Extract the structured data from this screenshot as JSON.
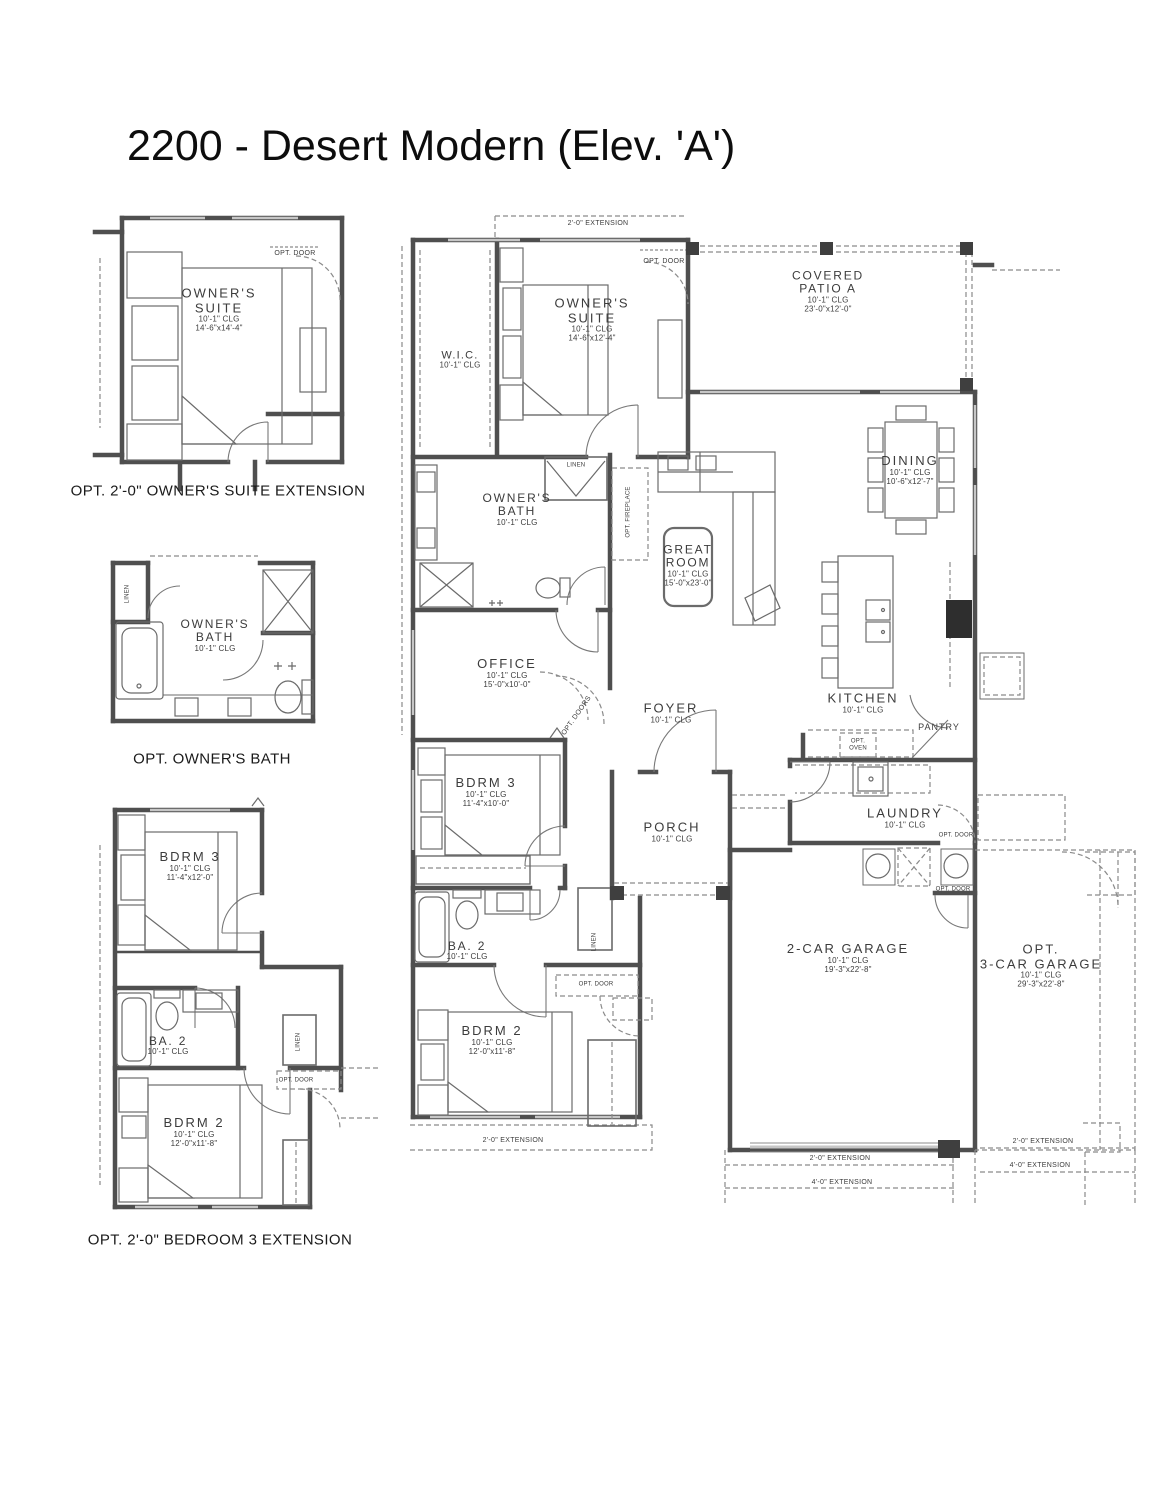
{
  "title": "2200 - Desert Modern (Elev. 'A')",
  "captions": {
    "owners_suite_extension": "OPT. 2'-0\" OWNER'S SUITE EXTENSION",
    "owners_bath": "OPT. OWNER'S BATH",
    "bedroom3_extension": "OPT. 2'-0\" BEDROOM 3 EXTENSION"
  },
  "rooms": {
    "ext_owners_suite": {
      "name1": "OWNER'S",
      "name2": "SUITE",
      "clg": "10'-1\" CLG",
      "dims": "14'-6\"x14'-4\""
    },
    "opt_owners_bath": {
      "name1": "OWNER'S",
      "name2": "BATH",
      "clg": "10'-1\" CLG"
    },
    "ext_bdrm3": {
      "name": "BDRM 3",
      "clg": "10'-1\" CLG",
      "dims": "11'-4\"x12'-0\""
    },
    "ext_ba2": {
      "name": "BA. 2",
      "clg": "10'-1\" CLG"
    },
    "ext_bdrm2": {
      "name": "BDRM 2",
      "clg": "10'-1\" CLG",
      "dims": "12'-0\"x11'-8\""
    },
    "wic": {
      "name": "W.I.C.",
      "clg": "10'-1\" CLG"
    },
    "owners_suite": {
      "name1": "OWNER'S",
      "name2": "SUITE",
      "clg": "10'-1\" CLG",
      "dims": "14'-6\"x12'-4\""
    },
    "covered_patio": {
      "name1": "COVERED",
      "name2": "PATIO A",
      "clg": "10'-1\" CLG",
      "dims": "23'-0\"x12'-0\""
    },
    "dining": {
      "name": "DINING",
      "clg": "10'-1\" CLG",
      "dims": "10'-6\"x12'-7\""
    },
    "owners_bath": {
      "name1": "OWNER'S",
      "name2": "BATH",
      "clg": "10'-1\" CLG"
    },
    "great_room": {
      "name1": "GREAT",
      "name2": "ROOM",
      "clg": "10'-1\" CLG",
      "dims": "15'-0\"x23'-0\""
    },
    "office": {
      "name": "OFFICE",
      "clg": "10'-1\" CLG",
      "dims": "15'-0\"x10'-0\""
    },
    "kitchen": {
      "name": "KITCHEN",
      "clg": "10'-1\" CLG"
    },
    "foyer": {
      "name": "FOYER",
      "clg": "10'-1\" CLG"
    },
    "pantry": {
      "name": "PANTRY"
    },
    "laundry": {
      "name": "LAUNDRY",
      "clg": "10'-1\" CLG"
    },
    "bdrm3": {
      "name": "BDRM 3",
      "clg": "10'-1\" CLG",
      "dims": "11'-4\"x10'-0\""
    },
    "ba2": {
      "name": "BA. 2",
      "clg": "10'-1\" CLG"
    },
    "bdrm2": {
      "name": "BDRM 2",
      "clg": "10'-1\" CLG",
      "dims": "12'-0\"x11'-8\""
    },
    "porch": {
      "name": "PORCH",
      "clg": "10'-1\" CLG"
    },
    "garage_2car": {
      "name": "2-CAR GARAGE",
      "clg": "10'-1\" CLG",
      "dims": "19'-3\"x22'-8\""
    },
    "garage_3car": {
      "name1": "OPT.",
      "name2": "3-CAR GARAGE",
      "clg": "10'-1\" CLG",
      "dims": "29'-3\"x22'-8\""
    }
  },
  "annotations": {
    "opt_door": "OPT. DOOR",
    "opt_doors": "OPT. DOORS",
    "opt_oven1": "OPT.",
    "opt_oven2": "OVEN",
    "opt_fireplace": "OPT. FIREPLACE",
    "linen": "LINEN",
    "extension_2_0": "2'-0\" EXTENSION",
    "extension_4_0": "4'-0\" EXTENSION"
  }
}
